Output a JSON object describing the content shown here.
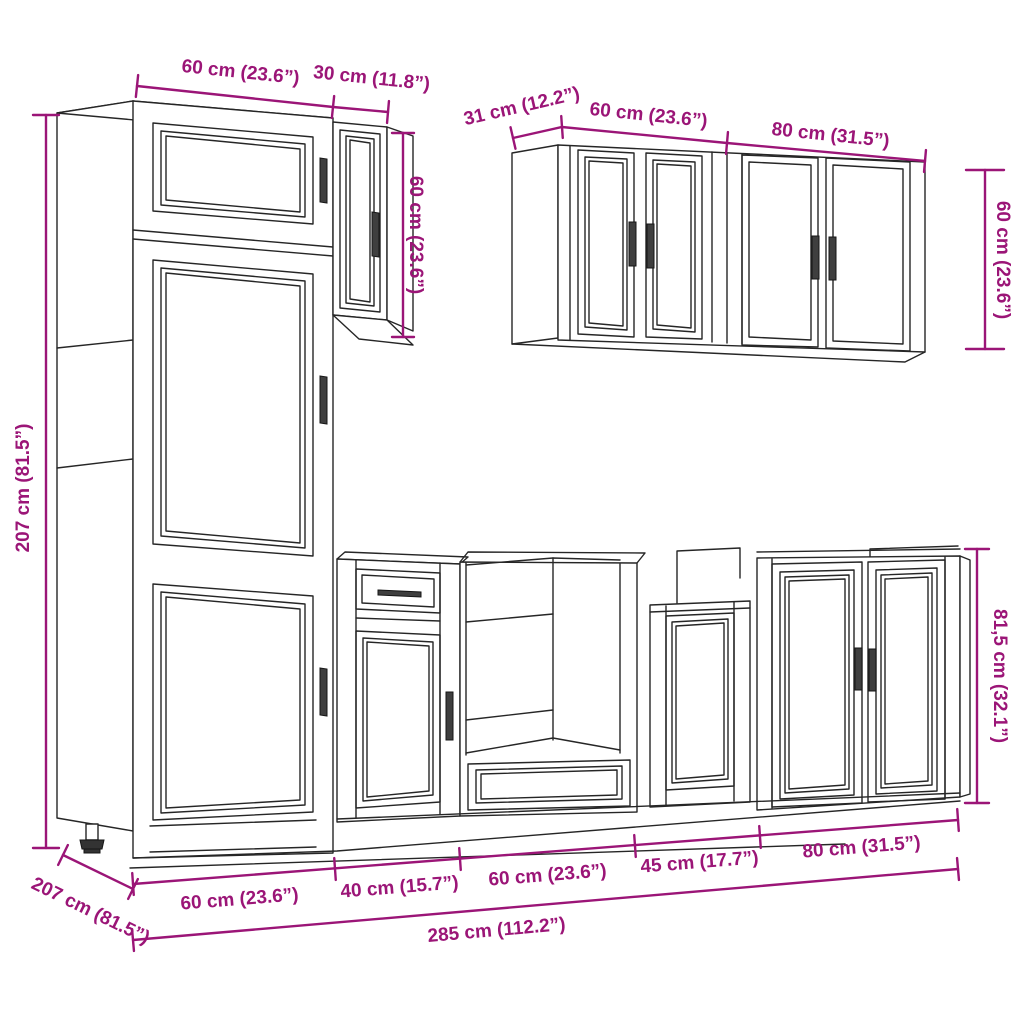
{
  "colors": {
    "dimension": "#9B1577",
    "line_art": "#262626",
    "background": "#FFFFFF"
  },
  "labels": {
    "tall_width": "60 cm (23.6”)",
    "wall_small_width": "30 cm (11.8”)",
    "wall_small_height": "60 cm (23.6”)",
    "wall_depth": "31 cm (12.2”)",
    "wall_60_width": "60 cm (23.6”)",
    "wall_80_width": "80 cm (31.5”)",
    "wall_height": "60 cm (23.6”)",
    "tall_height": "207 cm (81.5”)",
    "floor_depth": "207 cm (81.5”)",
    "base_60_left": "60 cm (23.6”)",
    "base_40": "40 cm (15.7”)",
    "base_60_mid": "60 cm (23.6”)",
    "base_45": "45 cm (17.7”)",
    "base_80": "80 cm (31.5”)",
    "total_width": "285 cm (112.2”)",
    "base_height": "81,5 cm (32.1”)"
  }
}
